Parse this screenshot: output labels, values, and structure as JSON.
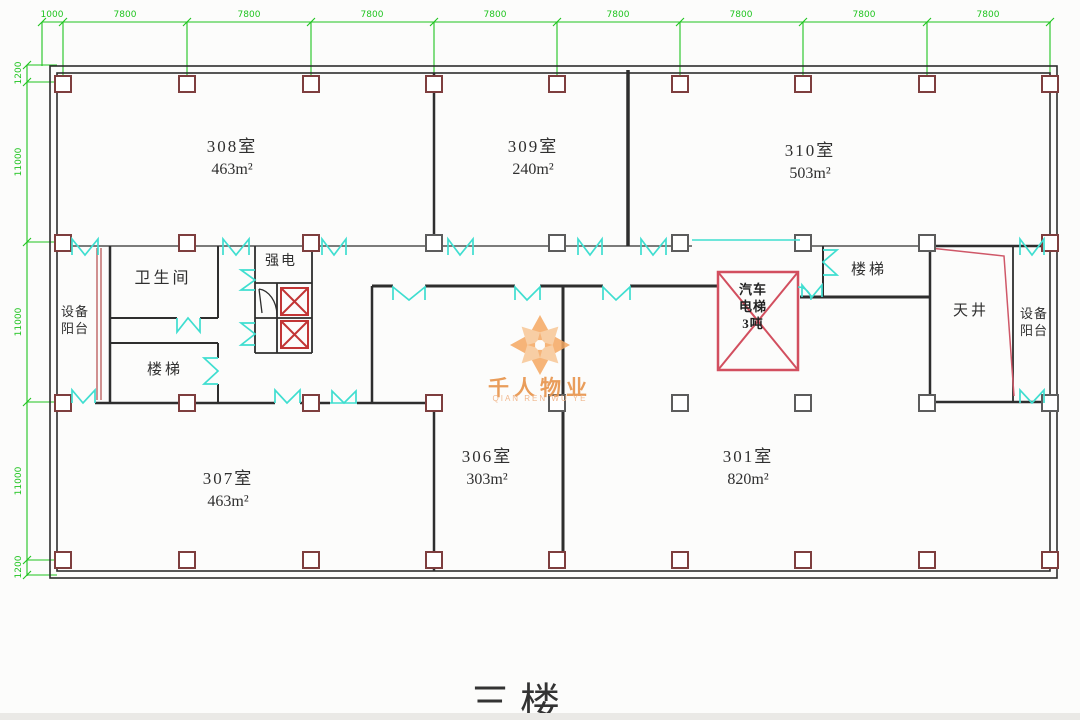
{
  "title": "三楼",
  "watermark": {
    "name": "千人物业",
    "subtitle": "QIAN REN WU YE"
  },
  "dimensions": {
    "top": [
      "1000",
      "7800",
      "7800",
      "7800",
      "7800",
      "7800",
      "7800",
      "7800",
      "7800"
    ],
    "left": [
      "1200",
      "11000",
      "11000",
      "11000",
      "1200"
    ]
  },
  "rooms": [
    {
      "label": "308室",
      "area": "463m²"
    },
    {
      "label": "309室",
      "area": "240m²"
    },
    {
      "label": "310室",
      "area": "503m²"
    },
    {
      "label": "307室",
      "area": "463m²"
    },
    {
      "label": "306室",
      "area": "303m²"
    },
    {
      "label": "301室",
      "area": "820m²"
    }
  ],
  "spaces": {
    "toilet": "卫生间",
    "strong_electric": "强电",
    "stairs_left": "楼梯",
    "stairs_right": "楼梯",
    "courtyard": "天井",
    "equip_balcony": {
      "line1": "设备",
      "line2": "阳台"
    },
    "car_elevator": {
      "line1": "汽车",
      "line2": "电梯",
      "line3": "3吨"
    }
  },
  "colors": {
    "dimension_green": "#1fc41f",
    "door_cyan": "#3fded0",
    "column_red": "#7e3e3e",
    "column_gray": "#5c5c5c",
    "wall_black": "#2e2e2e",
    "shaft_red": "#c23535",
    "car_elevator_red": "#d24f5f",
    "watermark_orange": "#e8964e"
  }
}
